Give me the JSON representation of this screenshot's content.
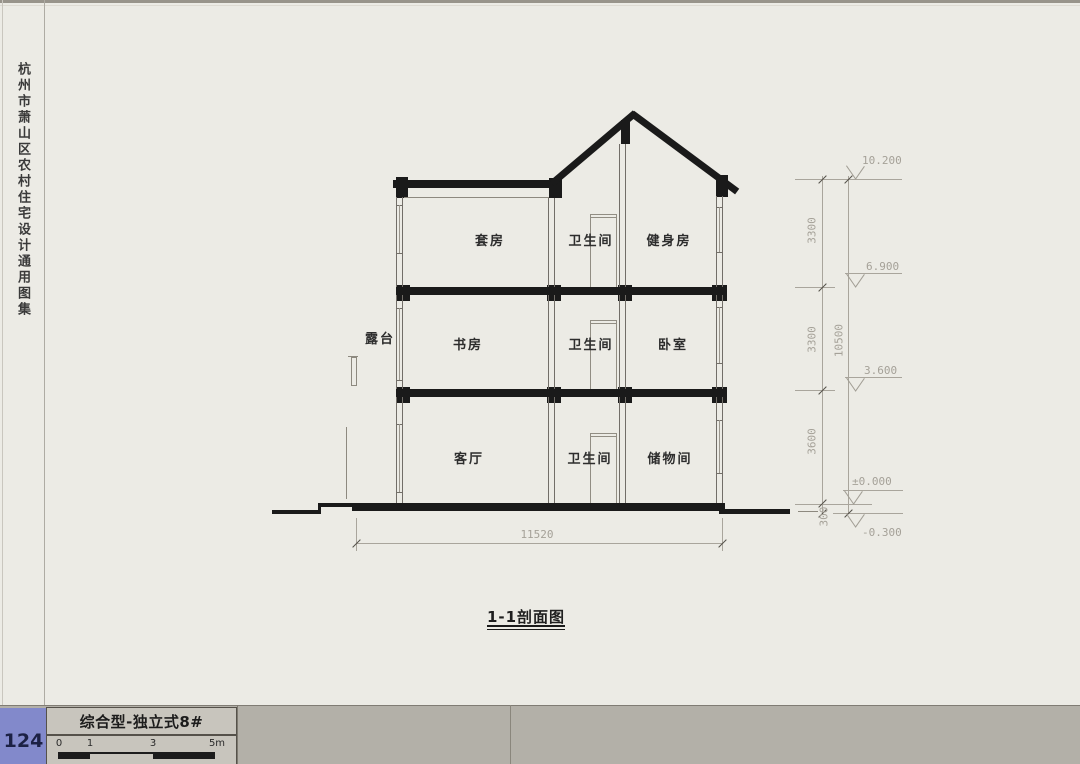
{
  "sidebar": {
    "title": "杭州市萧山区农村住宅设计通用图集"
  },
  "drawing": {
    "title": "1-1剖面图",
    "terrace_label": "露台",
    "floor3": [
      "套房",
      "卫生间",
      "健身房"
    ],
    "floor2": [
      "书房",
      "卫生间",
      "卧室"
    ],
    "floor1": [
      "客厅",
      "卫生间",
      "储物间"
    ],
    "dims": {
      "segments": [
        "3300",
        "3300",
        "3600",
        "300"
      ],
      "total": "10500",
      "overall_width": "11520"
    },
    "levels": [
      "10.200",
      "6.900",
      "3.600",
      "±0.000",
      "-0.300"
    ]
  },
  "footer": {
    "page_number": "124",
    "sheet_label": "综合型-独立式8#",
    "scale_marks": [
      "0",
      "1",
      "3",
      "5m"
    ]
  }
}
